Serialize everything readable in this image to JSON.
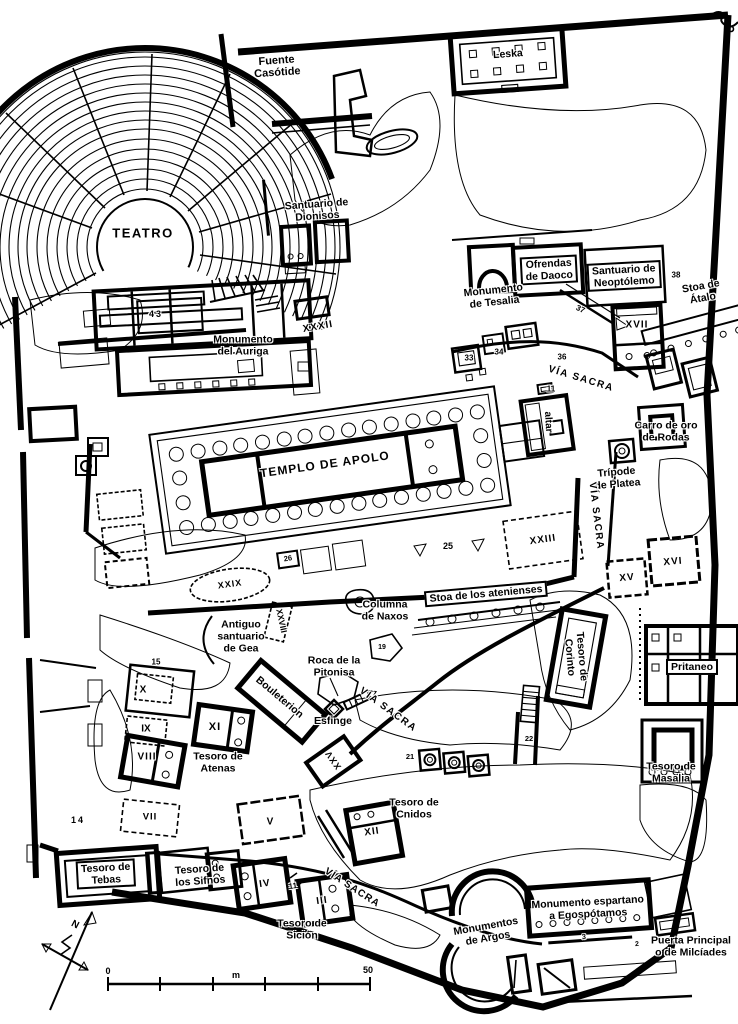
{
  "canvas": {
    "width": 738,
    "height": 1024,
    "ink": "#000000",
    "paper": "#ffffff"
  },
  "map_labels": [
    {
      "name": "label-teatro",
      "lines": [
        "TEATRO"
      ],
      "x": 143,
      "y": 234,
      "size": 13,
      "spacing": 1.5
    },
    {
      "name": "label-fuente-casotide",
      "lines": [
        "Fuente",
        "Casótide"
      ],
      "x": 277,
      "y": 67,
      "rot": -4,
      "size": 11
    },
    {
      "name": "label-leska",
      "lines": [
        "Leska"
      ],
      "x": 508,
      "y": 55,
      "rot": -4,
      "size": 10.5
    },
    {
      "name": "label-santuario-dionisos",
      "lines": [
        "Santuario de",
        "Dionisos"
      ],
      "x": 317,
      "y": 211,
      "rot": -4,
      "size": 10.5
    },
    {
      "name": "label-ofrendas-daoco",
      "lines": [
        "Ofrendas",
        "de Daoco"
      ],
      "x": 549,
      "y": 270,
      "rot": -3,
      "size": 10.5,
      "boxed": true
    },
    {
      "name": "label-santuario-neoptolemo",
      "lines": [
        "Santuario de",
        "Neoptólemo"
      ],
      "x": 624,
      "y": 276,
      "rot": -3,
      "size": 10.5,
      "boxed": true
    },
    {
      "name": "label-monumento-tesalia",
      "lines": [
        "Monumento",
        "de Tesalia"
      ],
      "x": 494,
      "y": 297,
      "rot": -6,
      "size": 10.5
    },
    {
      "name": "label-stoa-atalo",
      "lines": [
        "Stoa de",
        "Átalo"
      ],
      "x": 702,
      "y": 293,
      "rot": -10,
      "size": 10.5
    },
    {
      "name": "label-num-38",
      "lines": [
        "38"
      ],
      "x": 676,
      "y": 276,
      "size": 8
    },
    {
      "name": "label-xvii",
      "lines": [
        "XVII"
      ],
      "x": 637,
      "y": 325,
      "size": 10,
      "spacing": 1
    },
    {
      "name": "label-monumento-auriga",
      "lines": [
        "Monumento",
        "del Auriga"
      ],
      "x": 243,
      "y": 346,
      "size": 10.5
    },
    {
      "name": "label-num-43",
      "lines": [
        "43"
      ],
      "x": 156,
      "y": 314,
      "size": 9,
      "spacing": 2
    },
    {
      "name": "label-xxxii",
      "lines": [
        "XXXII"
      ],
      "x": 318,
      "y": 327,
      "rot": -10,
      "size": 10,
      "spacing": 1
    },
    {
      "name": "label-via-sacra-norte",
      "lines": [
        "VÍA SACRA"
      ],
      "x": 581,
      "y": 379,
      "rot": 17,
      "size": 10,
      "spacing": 1.5
    },
    {
      "name": "label-carro-oro",
      "lines": [
        "Carro de oro",
        "de Rodas"
      ],
      "x": 666,
      "y": 432,
      "size": 10.5
    },
    {
      "name": "label-tripode-platea",
      "lines": [
        "Trípode",
        "de Platea"
      ],
      "x": 617,
      "y": 479,
      "rot": -5,
      "size": 10.5
    },
    {
      "name": "label-altar",
      "lines": [
        "altar"
      ],
      "x": 548,
      "y": 422,
      "rot": 87,
      "size": 10
    },
    {
      "name": "label-num-11-altar",
      "lines": [
        "11"
      ],
      "x": 551,
      "y": 390,
      "size": 8
    },
    {
      "name": "label-num-37",
      "lines": [
        "37"
      ],
      "x": 580,
      "y": 310,
      "rot": 25,
      "size": 8
    },
    {
      "name": "label-num-33",
      "lines": [
        "33"
      ],
      "x": 469,
      "y": 359,
      "size": 8
    },
    {
      "name": "label-num-34",
      "lines": [
        "34"
      ],
      "x": 499,
      "y": 353,
      "size": 8
    },
    {
      "name": "label-num-36",
      "lines": [
        "36"
      ],
      "x": 562,
      "y": 358,
      "size": 8
    },
    {
      "name": "label-via-sacra-este",
      "lines": [
        "VÍA SACRA"
      ],
      "x": 596,
      "y": 516,
      "rot": 83,
      "size": 10,
      "spacing": 1.5
    },
    {
      "name": "label-xxiii",
      "lines": [
        "XXIII"
      ],
      "x": 543,
      "y": 540,
      "rot": -8,
      "size": 10,
      "spacing": 1
    },
    {
      "name": "label-num-25",
      "lines": [
        "25"
      ],
      "x": 448,
      "y": 546,
      "size": 9
    },
    {
      "name": "label-xv",
      "lines": [
        "XV"
      ],
      "x": 627,
      "y": 578,
      "rot": -5,
      "size": 10,
      "spacing": 1
    },
    {
      "name": "label-xvi",
      "lines": [
        "XVI"
      ],
      "x": 673,
      "y": 562,
      "rot": -5,
      "size": 10,
      "spacing": 1
    },
    {
      "name": "label-stoa-atenienses",
      "lines": [
        "Stoa de los atenienses"
      ],
      "x": 486,
      "y": 594,
      "rot": -5,
      "size": 10.5,
      "boxed": true
    },
    {
      "name": "label-columna-naxos",
      "lines": [
        "Columna",
        "de Naxos"
      ],
      "x": 385,
      "y": 611,
      "size": 10.5
    },
    {
      "name": "label-antiguo-gea",
      "lines": [
        "Antiguo",
        "santuario",
        "de Gea"
      ],
      "x": 241,
      "y": 637,
      "size": 10.5
    },
    {
      "name": "label-xxviii",
      "lines": [
        "XXVIII"
      ],
      "x": 281,
      "y": 621,
      "rot": 78,
      "size": 8.5
    },
    {
      "name": "label-tesoro-corinto",
      "lines": [
        "Tesoro de",
        "Corinto"
      ],
      "x": 575,
      "y": 657,
      "rot": 85,
      "size": 10.5
    },
    {
      "name": "label-pritaneo",
      "lines": [
        "Pritaneo"
      ],
      "x": 692,
      "y": 667,
      "size": 10.5,
      "boxed": true
    },
    {
      "name": "label-roca-pitonisa",
      "lines": [
        "Roca de la",
        "Pitonisa"
      ],
      "x": 334,
      "y": 667,
      "size": 10.5
    },
    {
      "name": "label-bouleterion",
      "lines": [
        "Bouleterion"
      ],
      "x": 279,
      "y": 698,
      "rot": 40,
      "size": 10.5
    },
    {
      "name": "label-esfinge",
      "lines": [
        "Esfinge"
      ],
      "x": 333,
      "y": 722,
      "size": 10.5
    },
    {
      "name": "label-via-sacra-centro",
      "lines": [
        "VÍA SACRA"
      ],
      "x": 388,
      "y": 710,
      "rot": 36,
      "size": 10,
      "spacing": 1.5
    },
    {
      "name": "label-xi",
      "lines": [
        "XI"
      ],
      "x": 215,
      "y": 727,
      "size": 11,
      "spacing": 1
    },
    {
      "name": "label-x",
      "lines": [
        "X"
      ],
      "x": 143,
      "y": 690,
      "size": 10
    },
    {
      "name": "label-ix",
      "lines": [
        "IX"
      ],
      "x": 146,
      "y": 729,
      "size": 10
    },
    {
      "name": "label-viii",
      "lines": [
        "VIII"
      ],
      "x": 147,
      "y": 757,
      "size": 10,
      "spacing": 1
    },
    {
      "name": "label-tesoro-atenas",
      "lines": [
        "Tesoro de",
        "Atenas"
      ],
      "x": 218,
      "y": 763,
      "size": 10.5
    },
    {
      "name": "label-xxv",
      "lines": [
        "XXV"
      ],
      "x": 333,
      "y": 760,
      "rot": -125,
      "size": 9,
      "spacing": 1
    },
    {
      "name": "label-num-15",
      "lines": [
        "15"
      ],
      "x": 156,
      "y": 663,
      "size": 8
    },
    {
      "name": "label-num-14",
      "lines": [
        "14"
      ],
      "x": 78,
      "y": 820,
      "size": 9,
      "spacing": 2
    },
    {
      "name": "label-vii",
      "lines": [
        "VII"
      ],
      "x": 150,
      "y": 818,
      "size": 9.5,
      "spacing": 1
    },
    {
      "name": "label-v",
      "lines": [
        "V"
      ],
      "x": 270,
      "y": 822,
      "size": 10
    },
    {
      "name": "label-num-26",
      "lines": [
        "26"
      ],
      "x": 288,
      "y": 559,
      "rot": -8,
      "size": 7.5
    },
    {
      "name": "label-xxix",
      "lines": [
        "XXIX"
      ],
      "x": 230,
      "y": 584,
      "rot": -8,
      "size": 9,
      "spacing": 1
    },
    {
      "name": "label-num-19",
      "lines": [
        "19"
      ],
      "x": 382,
      "y": 648,
      "size": 7
    },
    {
      "name": "label-tesoro-cnidos",
      "lines": [
        "Tesoro de",
        "Cnidos"
      ],
      "x": 414,
      "y": 809,
      "size": 10.5
    },
    {
      "name": "label-xii",
      "lines": [
        "XII"
      ],
      "x": 372,
      "y": 832,
      "rot": -8,
      "size": 10,
      "spacing": 1
    },
    {
      "name": "label-num-21",
      "lines": [
        "21"
      ],
      "x": 410,
      "y": 757,
      "size": 7.5
    },
    {
      "name": "label-num-22",
      "lines": [
        "22"
      ],
      "x": 529,
      "y": 739,
      "size": 7.5
    },
    {
      "name": "label-tesoro-masalia",
      "lines": [
        "Tesoro de",
        "Masalia"
      ],
      "x": 671,
      "y": 773,
      "size": 10.5
    },
    {
      "name": "label-tesoro-tebas",
      "lines": [
        "Tesoro de",
        "Tebas"
      ],
      "x": 106,
      "y": 874,
      "rot": -3,
      "size": 10.5,
      "boxed": true
    },
    {
      "name": "label-tesoro-sifnos",
      "lines": [
        "Tesoro de",
        "los Sifnos"
      ],
      "x": 200,
      "y": 876,
      "rot": -4,
      "size": 10.5
    },
    {
      "name": "label-iv",
      "lines": [
        "IV"
      ],
      "x": 265,
      "y": 884,
      "rot": -8,
      "size": 10,
      "spacing": 1
    },
    {
      "name": "label-num-11-iv",
      "lines": [
        "11"
      ],
      "x": 293,
      "y": 887,
      "rot": -8,
      "size": 8
    },
    {
      "name": "label-iii",
      "lines": [
        "III"
      ],
      "x": 322,
      "y": 901,
      "rot": -8,
      "size": 10,
      "spacing": 1
    },
    {
      "name": "label-tesoro-sicion",
      "lines": [
        "Tesoro de",
        "Sición"
      ],
      "x": 302,
      "y": 930,
      "size": 10.5
    },
    {
      "name": "label-via-sacra-sur",
      "lines": [
        "VÍA SACRA"
      ],
      "x": 352,
      "y": 888,
      "rot": 33,
      "size": 10,
      "spacing": 1
    },
    {
      "name": "label-monumentos-argos",
      "lines": [
        "Monumentos",
        "de Argos"
      ],
      "x": 487,
      "y": 933,
      "rot": -10,
      "size": 10.5
    },
    {
      "name": "label-monumento-espartano",
      "lines": [
        "Monumento espartano",
        "a Egospótamos"
      ],
      "x": 588,
      "y": 909,
      "rot": -3,
      "size": 10.5
    },
    {
      "name": "label-puerta-principal",
      "lines": [
        "Puerta Principal",
        "o de Milcíades"
      ],
      "x": 691,
      "y": 947,
      "size": 10.5
    },
    {
      "name": "label-templo-apolo",
      "lines": [
        "TEMPLO DE APOLO"
      ],
      "x": 325,
      "y": 465,
      "rot": -8,
      "size": 12,
      "spacing": 1
    },
    {
      "name": "label-compass-n",
      "lines": [
        "N"
      ],
      "x": 75,
      "y": 925,
      "rot": 28,
      "size": 10
    },
    {
      "name": "label-scale-0",
      "lines": [
        "0"
      ],
      "x": 108,
      "y": 971,
      "size": 9
    },
    {
      "name": "label-scale-m",
      "lines": [
        "m"
      ],
      "x": 236,
      "y": 975,
      "size": 9
    },
    {
      "name": "label-scale-50",
      "lines": [
        "50"
      ],
      "x": 368,
      "y": 970,
      "size": 9
    },
    {
      "name": "label-num-3",
      "lines": [
        "3"
      ],
      "x": 584,
      "y": 938,
      "rot": -3,
      "size": 7
    },
    {
      "name": "label-num-2",
      "lines": [
        "2"
      ],
      "x": 637,
      "y": 945,
      "rot": -3,
      "size": 7
    }
  ]
}
